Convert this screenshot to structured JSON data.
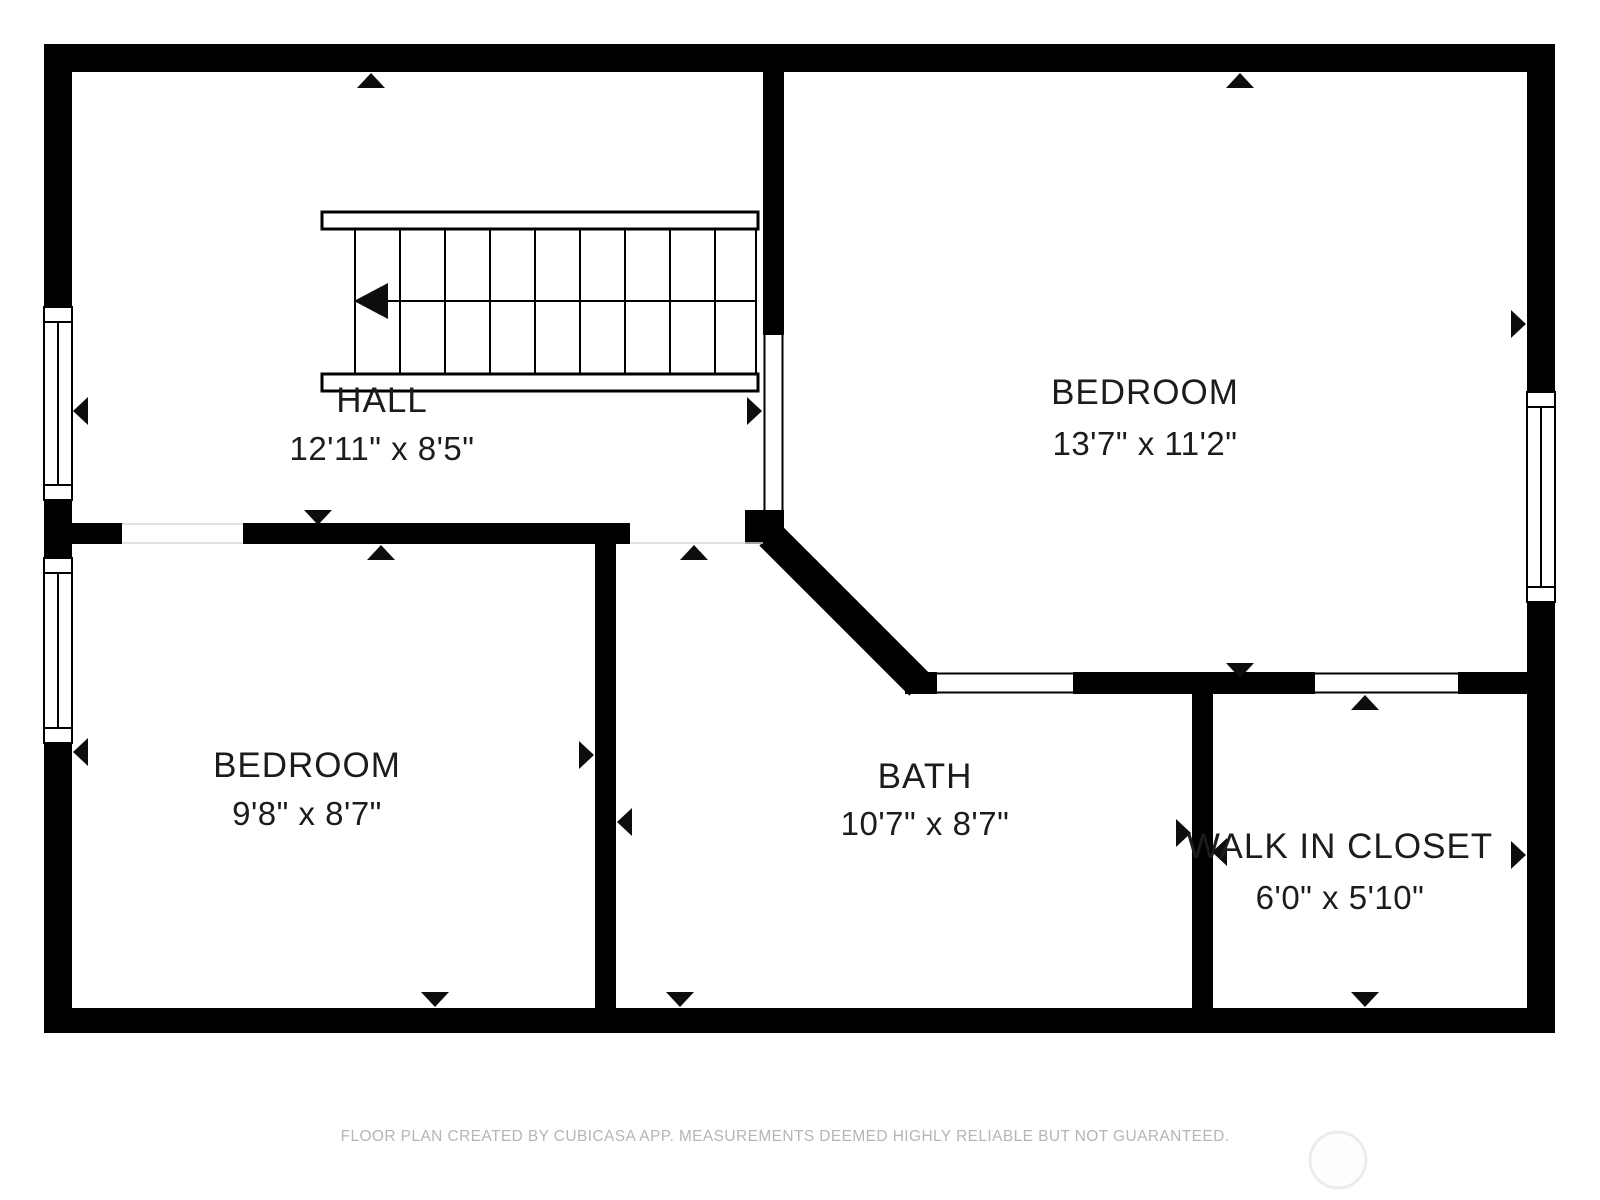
{
  "rooms": [
    {
      "name": "HALL",
      "dimensions": "12'11\" x 8'5\""
    },
    {
      "name": "BEDROOM",
      "dimensions": "13'7\" x 11'2\""
    },
    {
      "name": "BEDROOM",
      "dimensions": "9'8\" x 8'7\""
    },
    {
      "name": "BATH",
      "dimensions": "10'7\" x 8'7\""
    },
    {
      "name": "WALK IN CLOSET",
      "dimensions": "6'0\" x 5'10\""
    }
  ],
  "footer": {
    "disclaimer": "FLOOR PLAN CREATED BY CUBICASA APP. MEASUREMENTS DEEMED HIGHLY RELIABLE BUT NOT GUARANTEED."
  },
  "colors": {
    "wall": "#000000",
    "background": "#ffffff",
    "label_text": "#1c1c1c",
    "footer_text": "#b5b5b5"
  }
}
